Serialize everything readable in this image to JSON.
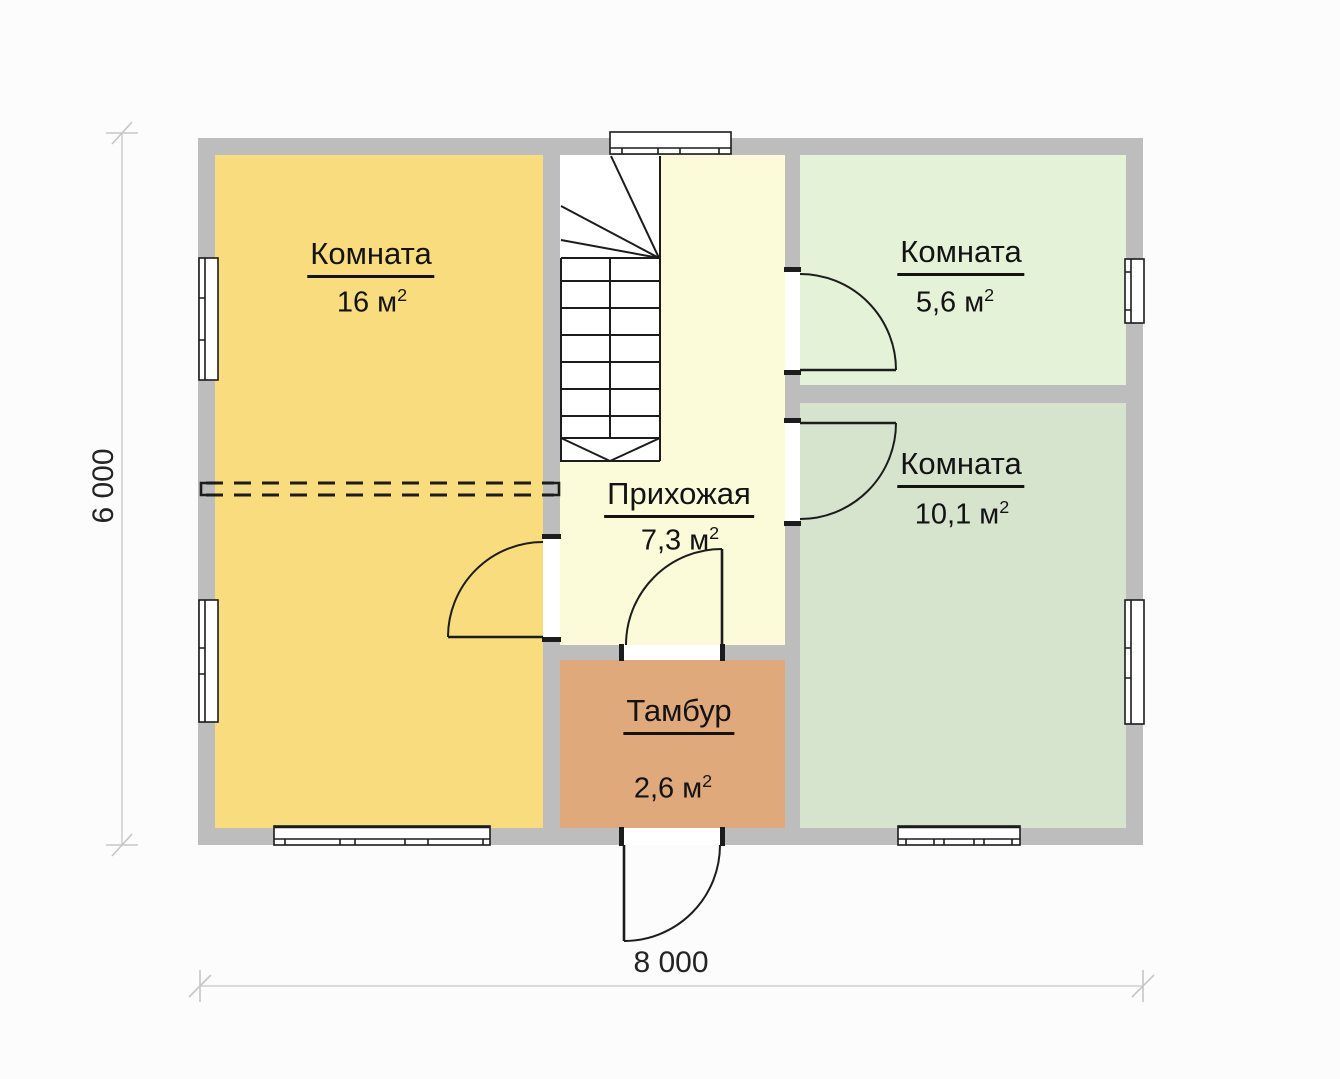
{
  "rooms": [
    {
      "name": "Комната",
      "area_value": "16 м",
      "area_sup": "2"
    },
    {
      "name": "Комната",
      "area_value": "5,6 м",
      "area_sup": "2"
    },
    {
      "name": "Комната",
      "area_value": "10,1 м",
      "area_sup": "2"
    },
    {
      "name": "Прихожая",
      "area_value": "7,3 м",
      "area_sup": "2"
    },
    {
      "name": "Тамбур",
      "area_value": "2,6 м",
      "area_sup": "2"
    }
  ],
  "dimensions": {
    "width_label": "8 000",
    "height_label": "6 000"
  },
  "colors": {
    "background": "#fcfcfc",
    "wall": "#bdbdbd",
    "room_16": "#f8dc7e",
    "hallway": "#fbfad9",
    "room_56": "#e4f3d8",
    "room_101": "#d6e4ce",
    "tambour": "#e0a97c",
    "line": "#1c1c1c",
    "dim_line": "#c6c6c6"
  }
}
